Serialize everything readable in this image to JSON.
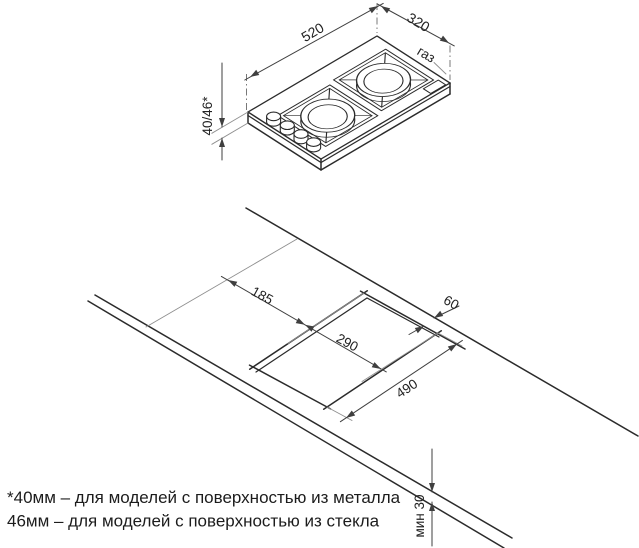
{
  "colors": {
    "ink": "#2b2b2b",
    "dim_line": "#3f3f3f",
    "ext_line": "#8f8f8f",
    "background": "#ffffff"
  },
  "drawing": {
    "hob": {
      "width_mm": "520",
      "depth_mm": "320",
      "height_mm": "40/46*",
      "gas_label": "газ"
    },
    "installation": {
      "front_distance_mm": "185",
      "cutout_depth_mm": "290",
      "cutout_width_mm": "490",
      "rear_distance_mm": "60",
      "min_thickness": "мин 30"
    },
    "notes": {
      "line1": "*40мм – для моделей с поверхностью из металла",
      "line2": "46мм – для моделей с поверхностью из стекла"
    }
  }
}
